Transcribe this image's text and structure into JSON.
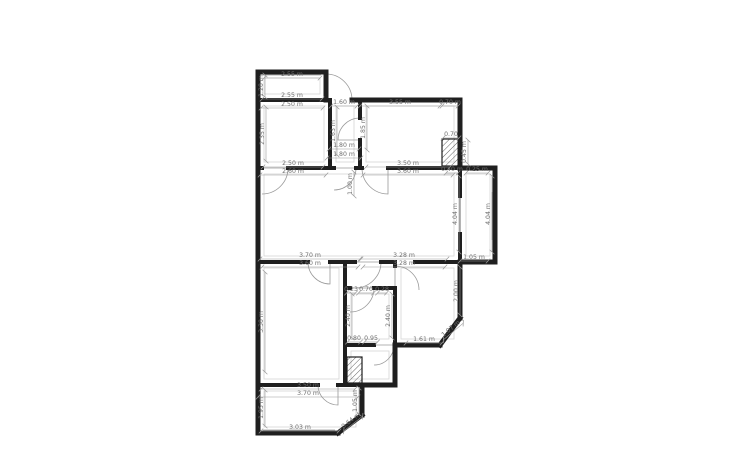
{
  "style": {
    "background": "#ffffff",
    "wall_color": "#1f1f1f",
    "thin_color": "#9a9a9a",
    "guide_color": "#d6d6d6",
    "label_color": "#6f6f6f",
    "label_size": 6.2
  },
  "canvas": {
    "width": 750,
    "height": 450
  },
  "walls_outer": [
    {
      "x1": 258,
      "y1": 72,
      "x2": 326,
      "y2": 72,
      "w": 5
    },
    {
      "x1": 326,
      "y1": 72,
      "x2": 326,
      "y2": 100,
      "w": 5
    },
    {
      "x1": 352,
      "y1": 100,
      "x2": 460,
      "y2": 100,
      "w": 5
    },
    {
      "x1": 460,
      "y1": 100,
      "x2": 460,
      "y2": 168,
      "w": 5
    },
    {
      "x1": 460,
      "y1": 168,
      "x2": 495,
      "y2": 168,
      "w": 5
    },
    {
      "x1": 495,
      "y1": 168,
      "x2": 495,
      "y2": 262,
      "w": 5
    },
    {
      "x1": 495,
      "y1": 262,
      "x2": 460,
      "y2": 262,
      "w": 5
    },
    {
      "x1": 460,
      "y1": 262,
      "x2": 460,
      "y2": 318,
      "w": 5
    },
    {
      "x1": 460,
      "y1": 318,
      "x2": 440,
      "y2": 345,
      "w": 5
    },
    {
      "x1": 440,
      "y1": 345,
      "x2": 395,
      "y2": 345,
      "w": 5
    },
    {
      "x1": 395,
      "y1": 345,
      "x2": 395,
      "y2": 385,
      "w": 5
    },
    {
      "x1": 395,
      "y1": 385,
      "x2": 362,
      "y2": 385,
      "w": 5
    },
    {
      "x1": 362,
      "y1": 385,
      "x2": 362,
      "y2": 415,
      "w": 5
    },
    {
      "x1": 362,
      "y1": 415,
      "x2": 338,
      "y2": 433,
      "w": 5
    },
    {
      "x1": 338,
      "y1": 433,
      "x2": 258,
      "y2": 433,
      "w": 5
    },
    {
      "x1": 258,
      "y1": 433,
      "x2": 258,
      "y2": 72,
      "w": 5
    }
  ],
  "walls_inner": [
    {
      "x1": 258,
      "y1": 100,
      "x2": 330,
      "y2": 100,
      "w": 4
    },
    {
      "x1": 330,
      "y1": 100,
      "x2": 330,
      "y2": 168,
      "w": 4
    },
    {
      "x1": 360,
      "y1": 100,
      "x2": 360,
      "y2": 118,
      "w": 4
    },
    {
      "x1": 360,
      "y1": 140,
      "x2": 360,
      "y2": 168,
      "w": 4
    },
    {
      "x1": 258,
      "y1": 168,
      "x2": 262,
      "y2": 168,
      "w": 4
    },
    {
      "x1": 288,
      "y1": 168,
      "x2": 330,
      "y2": 168,
      "w": 4
    },
    {
      "x1": 330,
      "y1": 168,
      "x2": 334,
      "y2": 168,
      "w": 4
    },
    {
      "x1": 356,
      "y1": 168,
      "x2": 362,
      "y2": 168,
      "w": 4
    },
    {
      "x1": 388,
      "y1": 168,
      "x2": 460,
      "y2": 168,
      "w": 4
    },
    {
      "x1": 460,
      "y1": 168,
      "x2": 460,
      "y2": 196,
      "w": 4
    },
    {
      "x1": 460,
      "y1": 234,
      "x2": 460,
      "y2": 262,
      "w": 4
    },
    {
      "x1": 258,
      "y1": 262,
      "x2": 308,
      "y2": 262,
      "w": 4
    },
    {
      "x1": 330,
      "y1": 262,
      "x2": 355,
      "y2": 262,
      "w": 4
    },
    {
      "x1": 381,
      "y1": 262,
      "x2": 395,
      "y2": 262,
      "w": 4
    },
    {
      "x1": 415,
      "y1": 262,
      "x2": 460,
      "y2": 262,
      "w": 4
    },
    {
      "x1": 345,
      "y1": 262,
      "x2": 345,
      "y2": 385,
      "w": 4
    },
    {
      "x1": 345,
      "y1": 288,
      "x2": 350,
      "y2": 288,
      "w": 4
    },
    {
      "x1": 374,
      "y1": 288,
      "x2": 395,
      "y2": 288,
      "w": 4
    },
    {
      "x1": 395,
      "y1": 262,
      "x2": 395,
      "y2": 266,
      "w": 4
    },
    {
      "x1": 395,
      "y1": 290,
      "x2": 395,
      "y2": 345,
      "w": 4
    },
    {
      "x1": 345,
      "y1": 345,
      "x2": 374,
      "y2": 345,
      "w": 4
    },
    {
      "x1": 258,
      "y1": 385,
      "x2": 318,
      "y2": 385,
      "w": 4
    },
    {
      "x1": 338,
      "y1": 385,
      "x2": 362,
      "y2": 385,
      "w": 4
    }
  ],
  "windows": [
    {
      "x1": 460,
      "y1": 196,
      "x2": 460,
      "y2": 234,
      "w": 1.5
    },
    {
      "x1": 492,
      "y1": 192,
      "x2": 492,
      "y2": 240,
      "w": 0.8
    },
    {
      "x1": 263,
      "y1": 75,
      "x2": 321,
      "y2": 75,
      "w": 0.8
    },
    {
      "x1": 263,
      "y1": 430,
      "x2": 335,
      "y2": 430,
      "w": 0.8
    }
  ],
  "hatches": [
    {
      "x": 442,
      "y": 139,
      "w": 18,
      "h": 27
    },
    {
      "x": 347,
      "y": 357,
      "w": 15,
      "h": 26
    }
  ],
  "guides": [
    {
      "x": 264,
      "y": 78,
      "w": 56,
      "h": 16
    },
    {
      "x": 264,
      "y": 106,
      "w": 60,
      "h": 56
    },
    {
      "x": 336,
      "y": 106,
      "w": 18,
      "h": 56
    },
    {
      "x": 366,
      "y": 106,
      "w": 88,
      "h": 56
    },
    {
      "x": 466,
      "y": 174,
      "w": 24,
      "h": 82
    },
    {
      "x": 264,
      "y": 174,
      "w": 190,
      "h": 82
    },
    {
      "x": 264,
      "y": 268,
      "w": 75,
      "h": 111
    },
    {
      "x": 351,
      "y": 294,
      "w": 38,
      "h": 45
    },
    {
      "x": 401,
      "y": 268,
      "w": 53,
      "h": 71
    },
    {
      "x": 351,
      "y": 351,
      "w": 38,
      "h": 28
    },
    {
      "x": 264,
      "y": 391,
      "w": 92,
      "h": 36
    }
  ],
  "doors": [
    {
      "cx": 326,
      "cy": 100,
      "r": 26,
      "a1": -90,
      "a2": 0
    },
    {
      "cx": 360,
      "cy": 140,
      "r": 22,
      "a1": 180,
      "a2": 270
    },
    {
      "cx": 334,
      "cy": 168,
      "r": 22,
      "a1": 0,
      "a2": 90
    },
    {
      "cx": 388,
      "cy": 168,
      "r": 26,
      "a1": 90,
      "a2": 180
    },
    {
      "cx": 262,
      "cy": 168,
      "r": 26,
      "a1": 0,
      "a2": 90
    },
    {
      "cx": 330,
      "cy": 262,
      "r": 22,
      "a1": 90,
      "a2": 180
    },
    {
      "cx": 355,
      "cy": 262,
      "r": 26,
      "a1": 0,
      "a2": 90
    },
    {
      "cx": 350,
      "cy": 288,
      "r": 24,
      "a1": 0,
      "a2": 90
    },
    {
      "cx": 395,
      "cy": 290,
      "r": 24,
      "a1": 270,
      "a2": 360
    },
    {
      "cx": 374,
      "cy": 345,
      "r": 20,
      "a1": 0,
      "a2": 90
    },
    {
      "cx": 338,
      "cy": 385,
      "r": 20,
      "a1": 90,
      "a2": 180
    }
  ],
  "dimensions": [
    {
      "x": 292,
      "y": 76,
      "rot": 0,
      "len": 56,
      "t": "2.55 m"
    },
    {
      "x": 292,
      "y": 97,
      "rot": 0,
      "len": 60,
      "t": "2.55 m"
    },
    {
      "x": 292,
      "y": 106,
      "rot": 0,
      "len": 62,
      "t": "2.50 m"
    },
    {
      "x": 344,
      "y": 104,
      "rot": 0,
      "len": 26,
      "t": "1.60 m"
    },
    {
      "x": 400,
      "y": 104,
      "rot": 0,
      "len": 80,
      "t": "3.55 m"
    },
    {
      "x": 450,
      "y": 104,
      "rot": 0,
      "len": 16,
      "t": "0.70 m"
    },
    {
      "x": 344,
      "y": 147,
      "rot": 0,
      "len": 30,
      "t": "1.80 m"
    },
    {
      "x": 344,
      "y": 156,
      "rot": 0,
      "len": 34,
      "t": "1.80 m"
    },
    {
      "x": 293,
      "y": 165,
      "rot": 0,
      "len": 60,
      "t": "2.50 m"
    },
    {
      "x": 293,
      "y": 173,
      "rot": 0,
      "len": 66,
      "t": "2.60 m"
    },
    {
      "x": 408,
      "y": 165,
      "rot": 0,
      "len": 84,
      "t": "3.50 m"
    },
    {
      "x": 408,
      "y": 173,
      "rot": 0,
      "len": 90,
      "t": "3.60 m"
    },
    {
      "x": 451,
      "y": 136,
      "rot": 0,
      "len": 16,
      "t": "0.70"
    },
    {
      "x": 452,
      "y": 171,
      "rot": 0,
      "len": 12,
      "t": "0.40 m"
    },
    {
      "x": 477,
      "y": 171,
      "rot": 0,
      "len": 22,
      "t": "0.25 m"
    },
    {
      "x": 310,
      "y": 257,
      "rot": 0,
      "len": 100,
      "t": "3.70 m"
    },
    {
      "x": 310,
      "y": 265,
      "rot": 0,
      "len": 96,
      "t": "3.60 m"
    },
    {
      "x": 404,
      "y": 257,
      "rot": 0,
      "len": 86,
      "t": "3.28 m"
    },
    {
      "x": 404,
      "y": 265,
      "rot": 0,
      "len": 82,
      "t": "3.28 m"
    },
    {
      "x": 474,
      "y": 259,
      "rot": 0,
      "len": 28,
      "t": "1.05 m"
    },
    {
      "x": 351,
      "y": 291,
      "rot": 0,
      "len": 9,
      "t": "0.23"
    },
    {
      "x": 366,
      "y": 291,
      "rot": 0,
      "len": 15,
      "t": "0.70"
    },
    {
      "x": 382,
      "y": 291,
      "rot": 0,
      "len": 9,
      "t": "0.28"
    },
    {
      "x": 354,
      "y": 340,
      "rot": 0,
      "len": 13,
      "t": "0.80"
    },
    {
      "x": 371,
      "y": 340,
      "rot": 0,
      "len": 13,
      "t": "0.95"
    },
    {
      "x": 424,
      "y": 341,
      "rot": 0,
      "len": 36,
      "t": "1.61 m"
    },
    {
      "x": 452,
      "y": 330,
      "rot": -40,
      "len": 26,
      "t": "1.07 m"
    },
    {
      "x": 308,
      "y": 387,
      "rot": 0,
      "len": 94,
      "t": "3.50 m"
    },
    {
      "x": 308,
      "y": 395,
      "rot": 0,
      "len": 100,
      "t": "3.70 m"
    },
    {
      "x": 300,
      "y": 429,
      "rot": 0,
      "len": 78,
      "t": "3.03 m"
    },
    {
      "x": 352,
      "y": 422,
      "rot": -38,
      "len": 24,
      "t": "0.64 m"
    },
    {
      "x": 263,
      "y": 86,
      "rot": -90,
      "len": 22,
      "t": "1.20 m"
    },
    {
      "x": 264,
      "y": 134,
      "rot": -90,
      "len": 54,
      "t": "2.35 m"
    },
    {
      "x": 335,
      "y": 131,
      "rot": -90,
      "len": 48,
      "t": "1.63 m"
    },
    {
      "x": 365,
      "y": 128,
      "rot": -90,
      "len": 44,
      "t": "1.85 m"
    },
    {
      "x": 352,
      "y": 184,
      "rot": -90,
      "len": 24,
      "t": "1.00 m"
    },
    {
      "x": 466,
      "y": 152,
      "rot": -90,
      "len": 24,
      "t": "0.45 m"
    },
    {
      "x": 457,
      "y": 214,
      "rot": -90,
      "len": 76,
      "t": "4.04 m"
    },
    {
      "x": 490,
      "y": 214,
      "rot": -90,
      "len": 76,
      "t": "4.04 m"
    },
    {
      "x": 263,
      "y": 322,
      "rot": -90,
      "len": 100,
      "t": "3.30 m"
    },
    {
      "x": 350,
      "y": 316,
      "rot": -90,
      "len": 44,
      "t": "2.40 m"
    },
    {
      "x": 390,
      "y": 316,
      "rot": -90,
      "len": 44,
      "t": "2.40 m"
    },
    {
      "x": 458,
      "y": 291,
      "rot": -90,
      "len": 48,
      "t": "2.00 m"
    },
    {
      "x": 263,
      "y": 408,
      "rot": -90,
      "len": 36,
      "t": "1.95 m"
    },
    {
      "x": 357,
      "y": 401,
      "rot": -90,
      "len": 26,
      "t": "1.05 m"
    }
  ]
}
